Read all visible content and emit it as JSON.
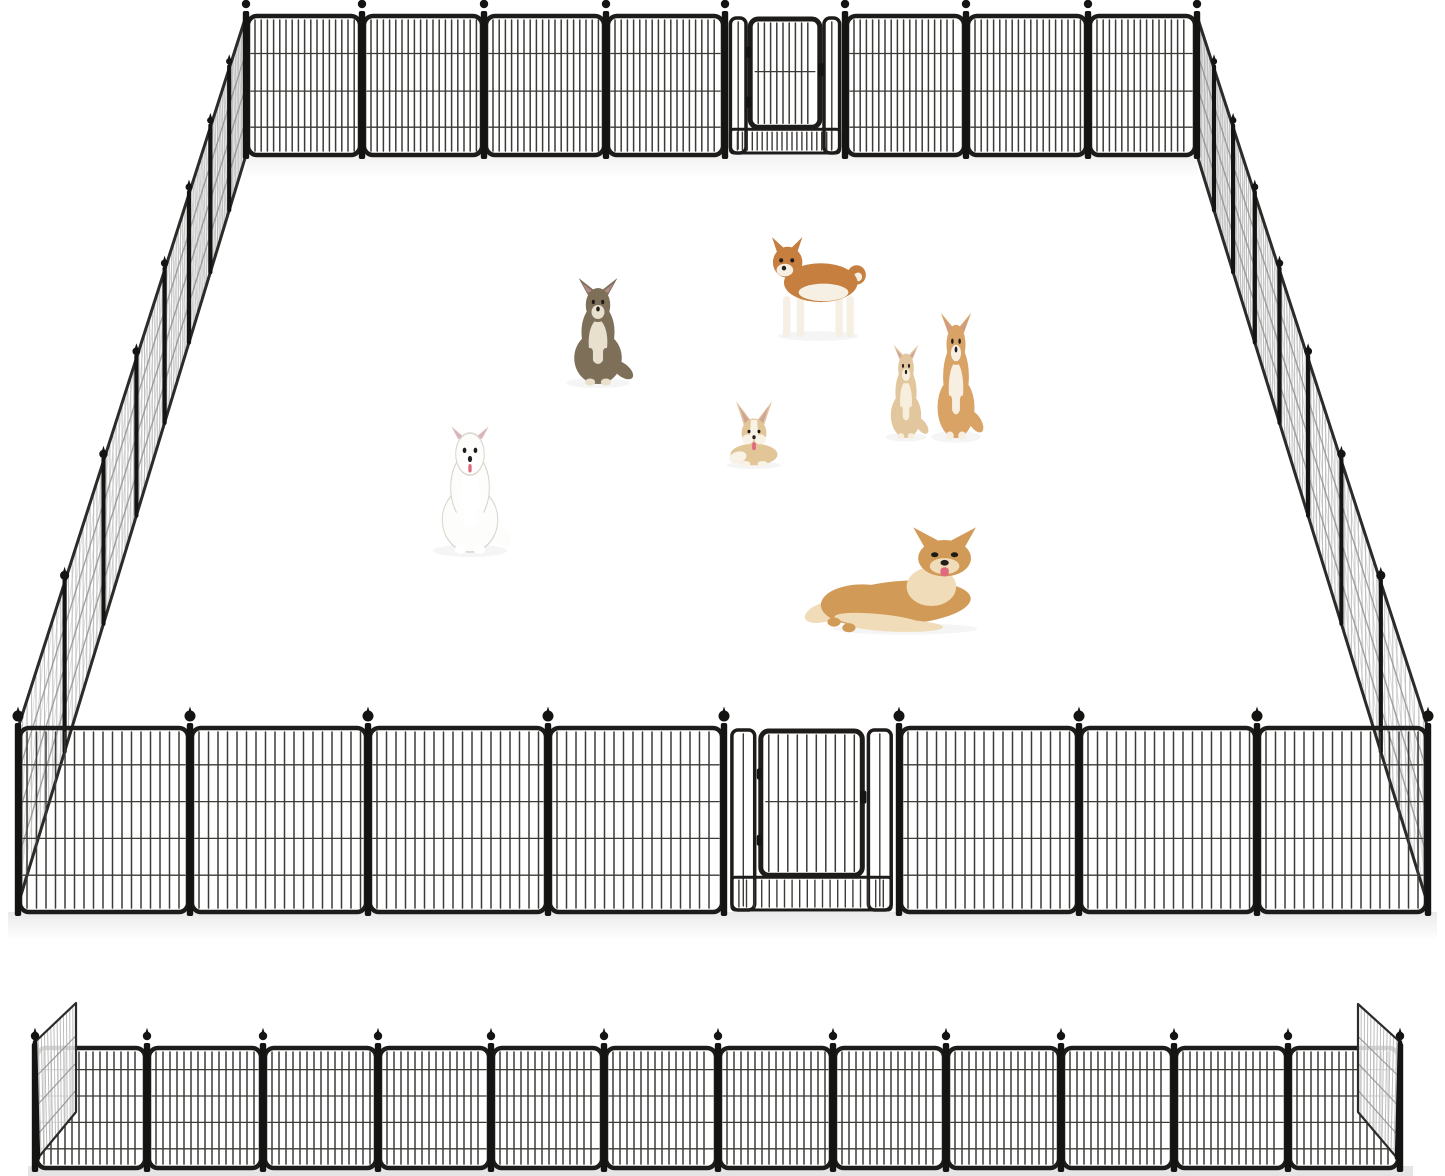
{
  "image": {
    "kind": "product-photo",
    "subject": "Heavy-duty metal dog playpen: assembled rectangular pen with walk-through gates front and back, seven dogs inside, and an unfolded flat row of panels shown below",
    "background": "#ffffff",
    "width": 1445,
    "height": 1176
  },
  "palette": {
    "frame": "#1d1c1a",
    "bar": "#3c3b38",
    "post": "#141413",
    "side_mesh": "#b6b6b6",
    "side_wire": "#8f8f8f",
    "side_edge": "#2c2b29",
    "ground_shadow": "#cfcfcf",
    "eye": "#1d1b19",
    "nose": "#221f1d",
    "tongue": "#e0697e",
    "inner_ear": "#c9959c"
  },
  "pen": {
    "perspective_k": 1.8,
    "back_wall": {
      "panel_count": 8,
      "gate_section": 4,
      "x_posts": [
        246,
        362,
        484,
        606,
        725,
        845,
        966,
        1088,
        1197
      ],
      "y_top": 16,
      "y_bottom": 155,
      "bar_step": 6.2,
      "wires": [
        0.27,
        0.54,
        0.8
      ],
      "finial_r": 4.2
    },
    "front_wall": {
      "panel_count": 8,
      "gate_section": 4,
      "x_posts": [
        18,
        190,
        368,
        548,
        724,
        899,
        1079,
        1257,
        1428
      ],
      "y_top": 728,
      "y_bottom": 912,
      "bar_step": 9.5,
      "wires": [
        0.2,
        0.4,
        0.6,
        0.8
      ],
      "finial_r": 5.5
    },
    "left_wall": {
      "panel_count": 8,
      "back": {
        "x": 246,
        "top": 16,
        "bottom": 155
      },
      "front": {
        "x": 18,
        "top": 728,
        "bottom": 905
      }
    },
    "right_wall": {
      "panel_count": 8,
      "back": {
        "x": 1197,
        "top": 16,
        "bottom": 155
      },
      "front": {
        "x": 1428,
        "top": 728,
        "bottom": 905
      }
    }
  },
  "gates": {
    "count": 2,
    "door_span": [
      0.21,
      0.79
    ],
    "door_bottom_frac": 0.8,
    "side_strip_span": [
      0.045,
      0.175
    ],
    "description": "walk-through door with rounded frame, low mesh band under the door, hinges left and latch right"
  },
  "strip": {
    "panel_count": 12,
    "x_posts": [
      35,
      147,
      263,
      378,
      491,
      604,
      718,
      833,
      946,
      1061,
      1174,
      1288,
      1400
    ],
    "y_top": 1048,
    "y_bottom": 1168,
    "bar_step": 7,
    "wires": [
      0.18,
      0.4,
      0.62,
      0.84
    ],
    "left_end_panel": [
      [
        35,
        1042
      ],
      [
        76,
        1003
      ],
      [
        76,
        1112
      ],
      [
        38,
        1158
      ]
    ],
    "right_end_panel": [
      [
        1400,
        1042
      ],
      [
        1358,
        1004
      ],
      [
        1358,
        1112
      ],
      [
        1397,
        1158
      ]
    ]
  },
  "dogs": [
    {
      "id": "longhair-chihuahua-sitting",
      "pose": "sit",
      "cx": 598,
      "feet": 384,
      "w": 72,
      "h": 100,
      "coat": "#7e6f59",
      "light": "#e9dfcd",
      "dark": "#4c443a",
      "tongue": false,
      "outline": false
    },
    {
      "id": "shiba-inu-standing",
      "pose": "stand",
      "cx": 818,
      "feet": 337,
      "w": 92,
      "h": 97,
      "coat": "#c67f3f",
      "light": "#f6efe3",
      "dark": "#8a5426",
      "tongue": false,
      "outline": false
    },
    {
      "id": "cream-chihuahua-puppy",
      "pose": "sit",
      "cx": 906,
      "feet": 438,
      "w": 46,
      "h": 88,
      "coat": "#e2c79e",
      "light": "#f7eedd",
      "dark": "#b08a57",
      "tongue": false,
      "outline": false
    },
    {
      "id": "shiba-puppy-sitting",
      "pose": "sit",
      "cx": 956,
      "feet": 438,
      "w": 56,
      "h": 118,
      "coat": "#d8a365",
      "light": "#f7efe2",
      "dark": "#a0702f",
      "tongue": false,
      "outline": false
    },
    {
      "id": "corgi-lying",
      "pose": "corgi",
      "cx": 754,
      "feet": 466,
      "w": 62,
      "h": 72,
      "coat": "#e2c698",
      "light": "#f9f3e7",
      "dark": "#bd9257",
      "tongue": true,
      "outline": false
    },
    {
      "id": "white-samoyed-sitting",
      "pose": "sit",
      "cx": 470,
      "feet": 552,
      "w": 84,
      "h": 124,
      "coat": "#fdfdfc",
      "light": "#ffffff",
      "dark": "#d9d4cd",
      "tongue": true,
      "outline": true
    },
    {
      "id": "golden-dog-lying",
      "pose": "lie",
      "cx": 905,
      "feet": 630,
      "w": 165,
      "h": 114,
      "coat": "#d29a57",
      "light": "#f0dcb8",
      "dark": "#a7712f",
      "tongue": true,
      "outline": false
    }
  ]
}
